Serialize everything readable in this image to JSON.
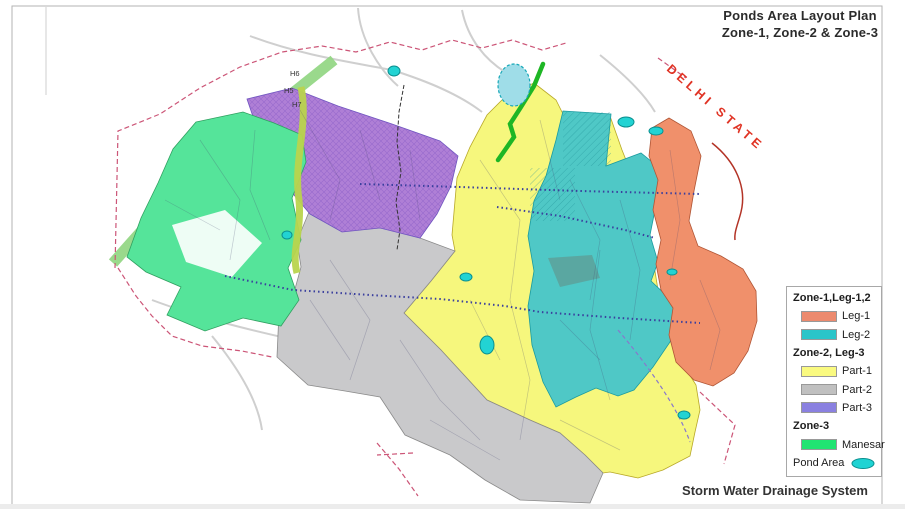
{
  "title": {
    "line1": "Ponds Area Layout Plan",
    "line2": "Zone-1, Zone-2 & Zone-3"
  },
  "footer": {
    "label": "Storm Water Drainage System"
  },
  "map": {
    "state_label": "DELHI STATE",
    "sector_labels": [
      "H6",
      "H5",
      "H7"
    ],
    "colors": {
      "part1": "#F6F77D",
      "part2": "#C9C9CB",
      "part3": "#AF7FD6",
      "leg1": "#F0906B",
      "leg2": "#4FC8C6",
      "manesar": "#55E49A",
      "pond": "#22D3D3",
      "pond_light": "#9FDDE8",
      "road_green": "#1EB625",
      "strip_green": "#8FD57F",
      "strip_olive": "#B9D44D",
      "boundary_red": "#CC5577",
      "state_red": "#E03324",
      "drain_blue": "#3A3F9E"
    }
  },
  "legend": {
    "rows": [
      {
        "type": "header",
        "label": "Zone-1,Leg-1,2"
      },
      {
        "type": "item",
        "label": "Leg-1",
        "color": "#EC8A6E"
      },
      {
        "type": "item",
        "label": "Leg-2",
        "color": "#2BC5C9"
      },
      {
        "type": "header",
        "label": "Zone-2, Leg-3"
      },
      {
        "type": "item",
        "label": "Part-1",
        "color": "#FAFA80"
      },
      {
        "type": "item",
        "label": "Part-2",
        "color": "#C0C0C0"
      },
      {
        "type": "item",
        "label": "Part-3",
        "color": "#8A80E0"
      },
      {
        "type": "header",
        "label": "Zone-3"
      },
      {
        "type": "item",
        "label": "Manesar",
        "color": "#21E472"
      },
      {
        "type": "pond",
        "label": "Pond Area",
        "color": "#1FD3D3"
      }
    ]
  }
}
